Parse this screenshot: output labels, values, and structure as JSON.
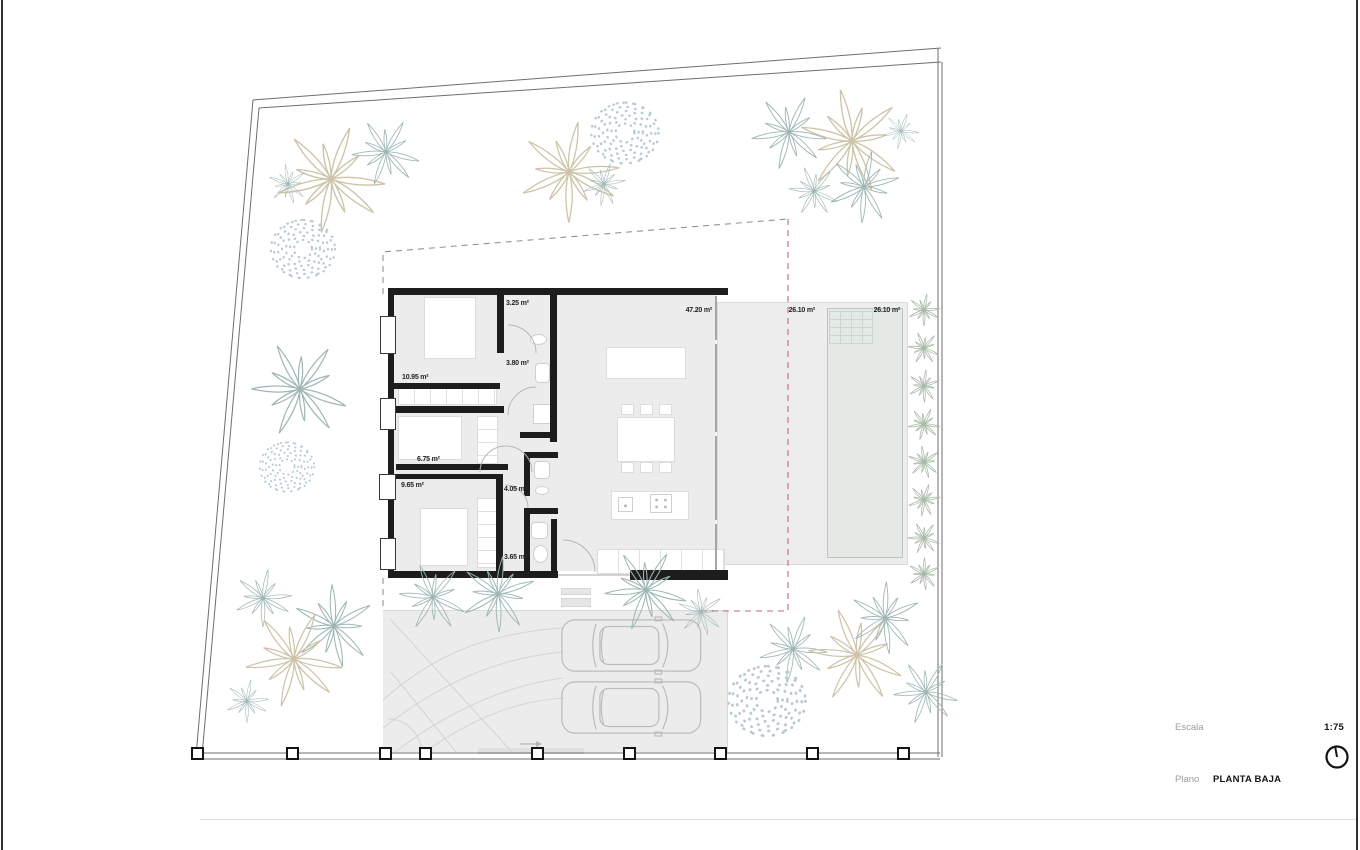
{
  "drawing": {
    "type": "architectural floor plan",
    "rooms": [
      {
        "name": "bathroom-1",
        "area": "3.25 m²"
      },
      {
        "name": "bathroom-hall",
        "area": "3.80 m²"
      },
      {
        "name": "bedroom-1",
        "area": "10.95 m²"
      },
      {
        "name": "bedroom-2",
        "area": "6.75 m²"
      },
      {
        "name": "bedroom-3",
        "area": "9.65 m²"
      },
      {
        "name": "bathroom-2",
        "area": "4.05 m²"
      },
      {
        "name": "bathroom-3",
        "area": "3.65 m²"
      },
      {
        "name": "living-kitchen",
        "area": "47.20 m²"
      },
      {
        "name": "terrace",
        "area": "26.10 m²"
      },
      {
        "name": "pool",
        "area": "26.10 m²"
      }
    ]
  },
  "title_block": {
    "scale_label": "Escala",
    "scale_value": "1:75",
    "plan_label": "Plano",
    "plan_value": "PLANTA BAJA"
  },
  "icons": {
    "north_indicator": "north-arrow-circle",
    "direction_arrow": "right-arrow"
  },
  "colors": {
    "wall": "#1d1d1d",
    "floor": "#ececec",
    "pool_fill": "#e4e9e6",
    "pool_border": "#b9c6bf",
    "setback_dash": "#8d9793",
    "boundary_accent_dash": "#c7696f",
    "palm_tan": "#cdc3a9",
    "palm_teal": "#9fb7b4",
    "shrub_speckle": "#b7cad3",
    "muted_text": "#9b9b9b"
  }
}
